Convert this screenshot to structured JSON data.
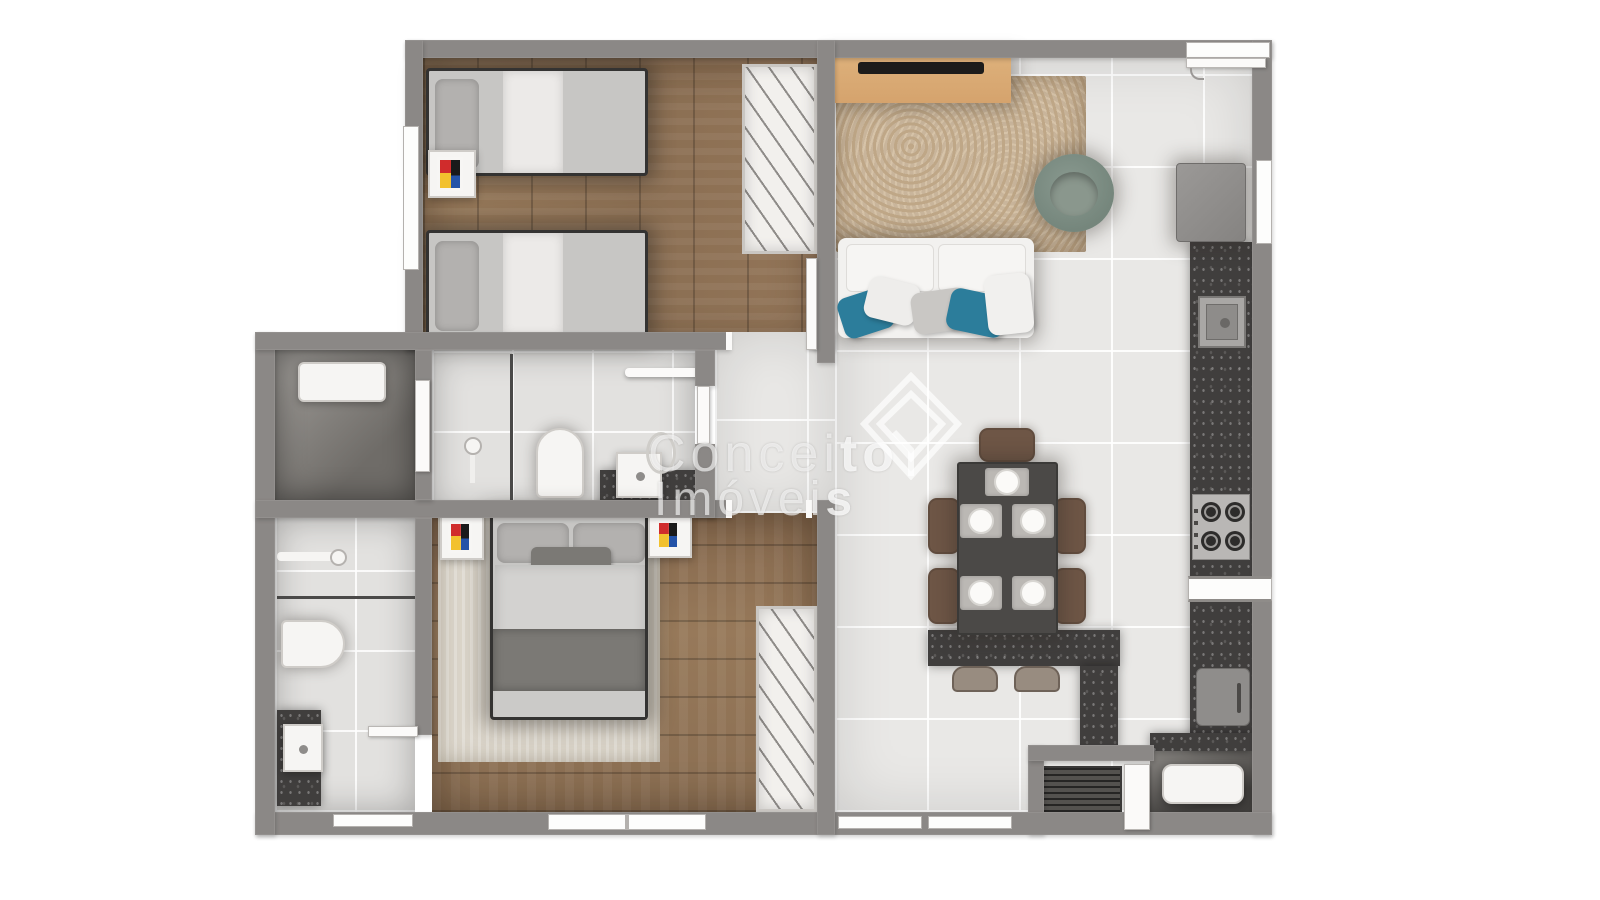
{
  "watermark": {
    "line1_regular": "Concei",
    "line1_bold": "to",
    "line2_regular": "Imóvei",
    "line2_bold": "s",
    "full_name": "Conceito Imóveis"
  },
  "palette": {
    "wall": "#8b8886",
    "wood": "#8f7456",
    "tile": "#e9e8e6",
    "granite": "#403e3d",
    "rug_living": "#c9b59b",
    "rug_master": "#dad4c9",
    "sofa_white": "#f2f1ef",
    "pillow_teal": "#2c7d9b",
    "armchair_sage": "#75867c",
    "console_wood": "#d5a36d",
    "tv_black": "#1d1c1b",
    "table_dark": "#4b4947",
    "chair_brown": "#6e5646",
    "stool_brown": "#988c80",
    "bed_gray": "#c7c6c4",
    "pillow_gray": "#b3b1af",
    "blanket_dark": "#7b7975",
    "fixture_white": "#f6f5f3",
    "washer_dark": "#54524f",
    "art_red": "#d02c2c",
    "art_blue": "#2453a8",
    "art_yellow": "#f2c12e",
    "art_black": "#1a1a1a"
  },
  "inventory": {
    "bedrooms": 2,
    "bathrooms": 2,
    "single_beds": 2,
    "double_beds": 1,
    "dining_chairs": 5,
    "counter_stools": 2,
    "wardrobes": 2,
    "sofa": 1,
    "armchair": 1,
    "fridge": 1,
    "stove_burners": 4,
    "washing_machine": 1
  }
}
